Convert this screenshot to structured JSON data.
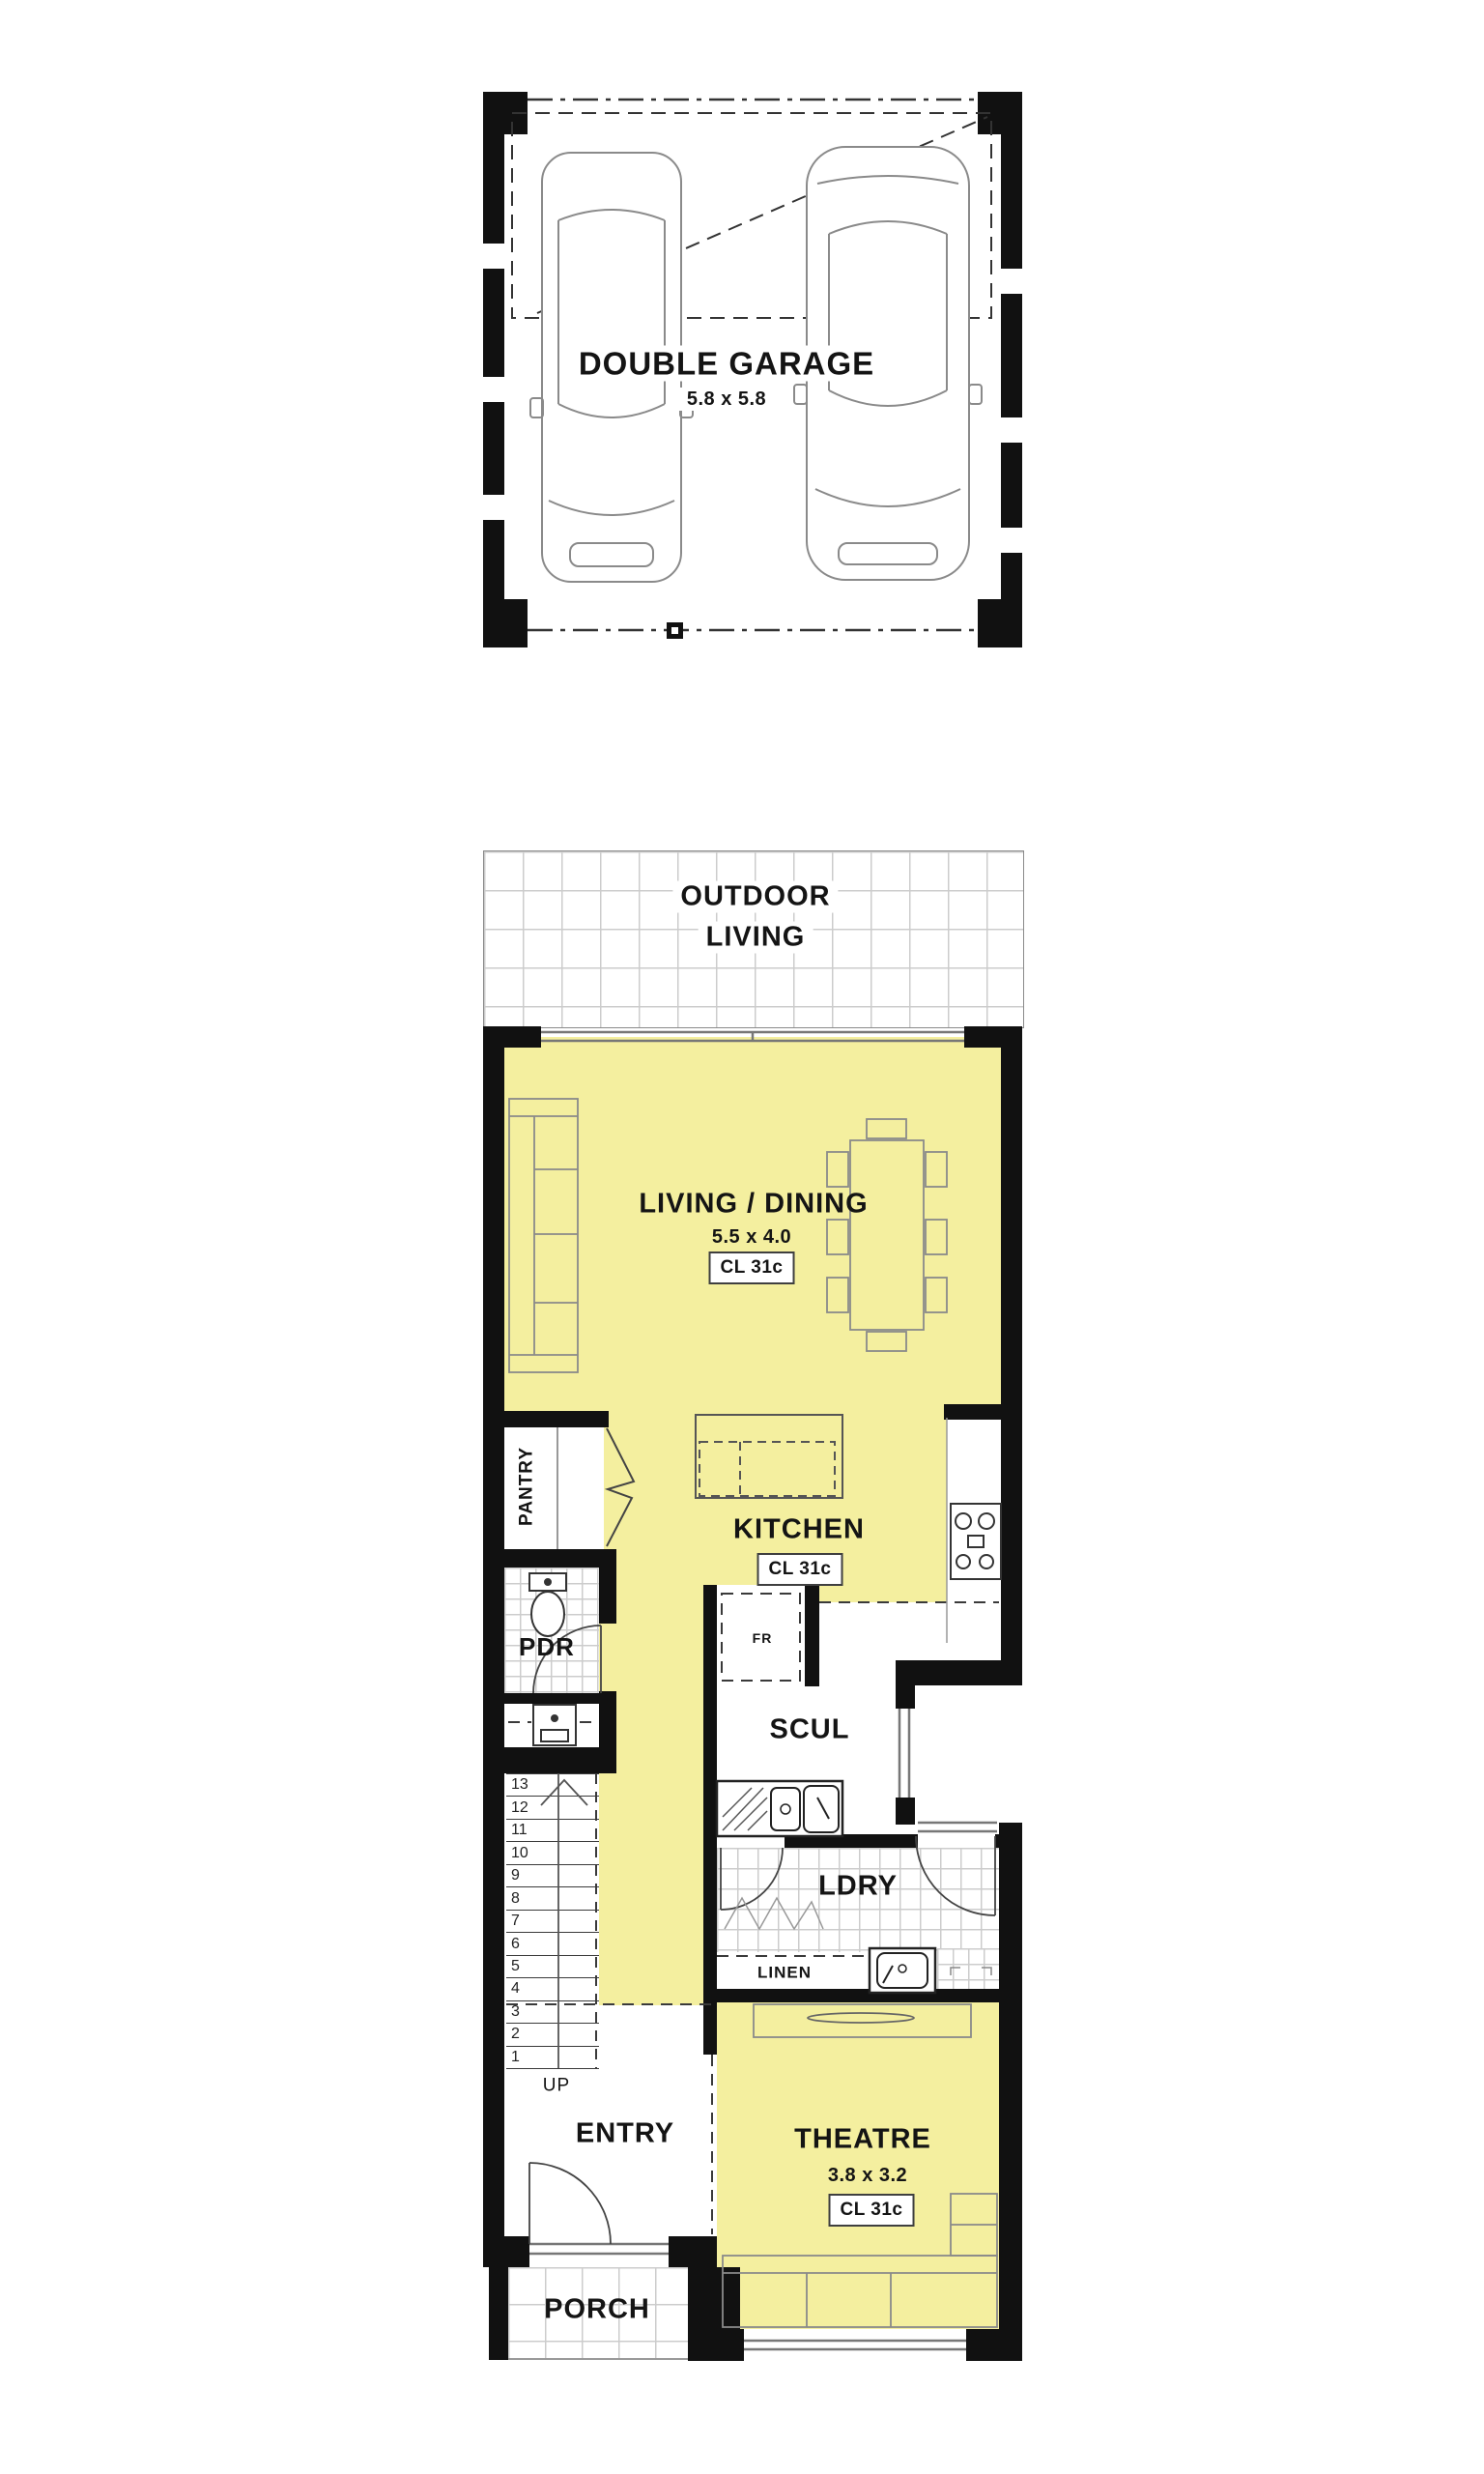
{
  "plan": {
    "garage": {
      "title": "DOUBLE GARAGE",
      "dims": "5.8 x 5.8"
    },
    "outdoor_living": {
      "line1": "OUTDOOR",
      "line2": "LIVING"
    },
    "living_dining": {
      "title": "LIVING / DINING",
      "dims": "5.5 x 4.0",
      "ceiling": "CL 31c"
    },
    "kitchen": {
      "title": "KITCHEN",
      "ceiling": "CL 31c",
      "fridge": "FR",
      "pantry": "PANTRY"
    },
    "powder": {
      "title": "PDR"
    },
    "scullery": {
      "title": "SCUL"
    },
    "laundry": {
      "title": "LDRY",
      "linen": "LINEN"
    },
    "stairs": {
      "numbers": [
        "13",
        "12",
        "11",
        "10",
        "9",
        "8",
        "7",
        "6",
        "5",
        "4",
        "3",
        "2",
        "1"
      ],
      "direction": "UP"
    },
    "entry": {
      "title": "ENTRY"
    },
    "theatre": {
      "title": "THEATRE",
      "dims": "3.8 x 3.2",
      "ceiling": "CL 31c"
    },
    "porch": {
      "title": "PORCH"
    }
  },
  "colors": {
    "room_fill": "#f4ef9f",
    "wall": "#111111",
    "tile_line": "#cccccc"
  }
}
